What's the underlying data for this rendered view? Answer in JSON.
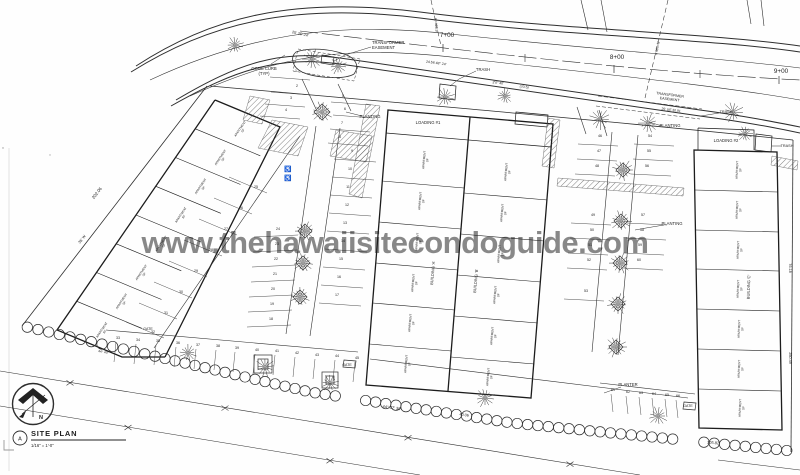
{
  "watermark": {
    "text": "www.thehawaiisitecondoguide.com",
    "color": "#a9a9a9"
  },
  "title_block": {
    "detail_letter": "A",
    "title": "SITE PLAN",
    "scale": "1/16\" = 1'-0\"",
    "north_letter": "N"
  },
  "stations": [
    {
      "label": "7+00",
      "x": 447,
      "y": 37,
      "tx": 443,
      "ty": 44
    },
    {
      "label": "8+00",
      "x": 617,
      "y": 59,
      "tx": 614,
      "ty": 65
    },
    {
      "label": "9+00",
      "x": 781,
      "y": 73,
      "tx": 779,
      "ty": 76
    }
  ],
  "unit_label": {
    "l1": "APARTMENT",
    "l2": "SF"
  },
  "buildings": {
    "names": [
      "BUILDING 'A'",
      "BUILDING 'B'",
      "BUILDING 'C'"
    ],
    "groups": [
      {
        "rot": -56,
        "pts": [
          [
            240.9,
            129.3
          ],
          [
            221.2,
            158
          ],
          [
            201.4,
            186.8
          ],
          [
            181.6,
            215.5
          ],
          [
            161.9,
            244.3
          ],
          [
            142.1,
            273
          ],
          [
            122.3,
            301.8
          ],
          [
            102.6,
            330.5
          ]
        ]
      },
      {
        "rot": -85,
        "pts": [
          [
            425,
            160
          ],
          [
            421,
            201
          ],
          [
            418,
            242
          ],
          [
            414,
            283
          ],
          [
            411,
            323
          ],
          [
            407,
            364
          ]
        ]
      },
      {
        "rot": -85,
        "pts": [
          [
            507,
            172
          ],
          [
            503,
            213
          ],
          [
            500,
            254
          ],
          [
            496,
            295
          ],
          [
            493,
            336
          ],
          [
            489,
            377
          ]
        ]
      },
      {
        "rot": -88,
        "pts": [
          [
            738,
            170
          ],
          [
            738,
            210
          ],
          [
            739,
            250
          ],
          [
            739,
            289
          ],
          [
            740,
            329
          ],
          [
            740,
            369
          ],
          [
            741,
            408
          ]
        ]
      }
    ]
  },
  "annotations": [
    {
      "lines": [
        "TRANSFORMER",
        "EASEMENT"
      ],
      "x": 372,
      "y": 44,
      "s": 4.2,
      "a": "start"
    },
    {
      "lines": [
        "CONC CURB",
        "(TYP)"
      ],
      "x": 264,
      "y": 70,
      "s": 4.2
    },
    {
      "t": "TRASH",
      "x": 483,
      "y": 71,
      "s": 4.2
    },
    {
      "t": "LOADING #1",
      "x": 428,
      "y": 124,
      "s": 4.2
    },
    {
      "t": "PLANTING",
      "x": 370,
      "y": 118,
      "s": 4.2
    },
    {
      "lines": [
        "TRANSFORMER",
        "EASEMENT"
      ],
      "x": 670,
      "y": 96,
      "s": 3.6,
      "r": 7
    },
    {
      "t": "25' UE  30.91",
      "x": 671,
      "y": 111,
      "s": 3.4,
      "r": 7
    },
    {
      "t": "PLANTING",
      "x": 670,
      "y": 127,
      "s": 4.2
    },
    {
      "t": "TRASH",
      "x": 726,
      "y": 113,
      "s": 3.8
    },
    {
      "t": "LOADING #2",
      "x": 726,
      "y": 142,
      "s": 4.2
    },
    {
      "t": "TRASH",
      "x": 787,
      "y": 147,
      "s": 3.8
    },
    {
      "t": "PLANTING",
      "x": 672,
      "y": 225,
      "s": 4.2
    },
    {
      "t": "PLANTER",
      "x": 628,
      "y": 386,
      "s": 4.2
    },
    {
      "t": "GATE",
      "x": 148,
      "y": 330,
      "s": 3.6
    },
    {
      "t": "GATE",
      "x": 347,
      "y": 366,
      "s": 3.6
    },
    {
      "t": "GATE",
      "x": 688,
      "y": 407,
      "s": 3.6
    },
    {
      "t": "202.06",
      "x": 98,
      "y": 194,
      "r": -52,
      "s": 4.4
    },
    {
      "t": "35' W",
      "x": 83,
      "y": 240,
      "r": -52,
      "s": 3.8
    },
    {
      "t": "25'   25'   24'",
      "x": 300,
      "y": 35,
      "r": 13,
      "s": 3.8
    },
    {
      "t": "24.56   48° 24'",
      "x": 436,
      "y": 64,
      "r": 8,
      "s": 3.5
    },
    {
      "t": "2'0\" 40'",
      "x": 498,
      "y": 84,
      "r": 7,
      "s": 3.5
    },
    {
      "t": "(70.5)",
      "x": 524,
      "y": 88,
      "r": 7,
      "s": 3.5
    },
    {
      "t": "R=428.9",
      "x": 435,
      "y": 25,
      "r": 85,
      "s": 3.5
    },
    {
      "t": "R=505.0",
      "x": 656,
      "y": 48,
      "r": 100,
      "s": 3.5
    },
    {
      "t": "44° 27' 30\"",
      "x": 392,
      "y": 409,
      "r": 8,
      "s": 4
    },
    {
      "t": "40.06",
      "x": 464,
      "y": 416,
      "r": 8,
      "s": 3.8
    },
    {
      "t": "105.82",
      "x": 713,
      "y": 444,
      "r": 4,
      "s": 4
    },
    {
      "t": "250.49",
      "x": 789,
      "y": 358,
      "r": 90,
      "s": 3.8
    },
    {
      "t": "76.18",
      "x": 789,
      "y": 268,
      "r": 90,
      "s": 3.8
    },
    {
      "t": "44° 40'",
      "x": 103,
      "y": 353,
      "r": 12,
      "s": 3.3
    },
    {
      "t": "♿",
      "x": 288,
      "y": 171,
      "s": 6
    },
    {
      "t": "♿",
      "x": 288,
      "y": 180,
      "s": 6
    },
    {
      "t": "BUILDING 'A'",
      "x": 434,
      "y": 273,
      "r": -85,
      "s": 4
    },
    {
      "t": "BUILDING 'B'",
      "x": 477,
      "y": 281,
      "r": -85,
      "s": 4
    },
    {
      "t": "BUILDING 'C'",
      "x": 750,
      "y": 287,
      "r": -88,
      "s": 4
    }
  ],
  "stalls": {
    "groups": [
      {
        "ox": -26,
        "oy": 5,
        "dx": 40,
        "dy": 3,
        "items": [
          {
            "n": "1",
            "x": 296,
            "y": 72
          },
          {
            "n": "2",
            "x": 297,
            "y": 87
          },
          {
            "n": "3",
            "x": 291,
            "y": 99
          },
          {
            "n": "4",
            "x": 286,
            "y": 111
          }
        ]
      },
      {
        "ox": -12,
        "oy": 5,
        "dx": 40,
        "dy": 3,
        "items": [
          {
            "n": "5",
            "x": 343,
            "y": 97
          },
          {
            "n": "6",
            "x": 345,
            "y": 110
          },
          {
            "n": "7",
            "x": 342,
            "y": 124
          },
          {
            "n": "8",
            "x": 340,
            "y": 138
          }
        ]
      },
      {
        "ox": -18,
        "oy": 7,
        "dx": 42,
        "dy": 3,
        "items": [
          {
            "n": "9",
            "x": 352,
            "y": 152
          },
          {
            "n": "10",
            "x": 350,
            "y": 170
          },
          {
            "n": "11",
            "x": 348,
            "y": 188
          },
          {
            "n": "12",
            "x": 347,
            "y": 206
          },
          {
            "n": "13",
            "x": 345,
            "y": 224
          },
          {
            "n": "14",
            "x": 343,
            "y": 242
          },
          {
            "n": "15",
            "x": 341,
            "y": 260
          },
          {
            "n": "16",
            "x": 339,
            "y": 278
          },
          {
            "n": "17",
            "x": 337,
            "y": 296
          }
        ]
      },
      {
        "ox": -24,
        "oy": 7,
        "dx": 44,
        "dy": -2,
        "items": [
          {
            "n": "24",
            "x": 278,
            "y": 230
          },
          {
            "n": "23",
            "x": 277,
            "y": 245
          },
          {
            "n": "22",
            "x": 276,
            "y": 260
          },
          {
            "n": "21",
            "x": 275,
            "y": 275
          },
          {
            "n": "20",
            "x": 273,
            "y": 290
          },
          {
            "n": "19",
            "x": 272,
            "y": 305
          },
          {
            "n": "18",
            "x": 271,
            "y": 320
          }
        ]
      },
      {
        "ox": -27,
        "oy": -11,
        "dx": 38,
        "dy": 16,
        "items": [
          {
            "n": "25",
            "x": 256,
            "y": 188
          },
          {
            "n": "26",
            "x": 241,
            "y": 209
          },
          {
            "n": "27",
            "x": 226,
            "y": 230
          },
          {
            "n": "28",
            "x": 211,
            "y": 251
          },
          {
            "n": "29",
            "x": 196,
            "y": 272
          },
          {
            "n": "30",
            "x": 181,
            "y": 293
          },
          {
            "n": "31",
            "x": 166,
            "y": 314
          },
          {
            "n": "32",
            "x": 153,
            "y": 333
          }
        ]
      },
      {
        "ox": -2,
        "oy": 3,
        "dx": -2,
        "dy": 20,
        "items": [
          {
            "n": "33",
            "x": 118,
            "y": 339
          },
          {
            "n": "34",
            "x": 138,
            "y": 341
          },
          {
            "n": "35",
            "x": 158,
            "y": 342
          },
          {
            "n": "36",
            "x": 178,
            "y": 344
          },
          {
            "n": "37",
            "x": 198,
            "y": 346
          },
          {
            "n": "38",
            "x": 218,
            "y": 347
          },
          {
            "n": "39",
            "x": 237,
            "y": 349
          },
          {
            "n": "40",
            "x": 257,
            "y": 351
          },
          {
            "n": "41",
            "x": 277,
            "y": 352
          },
          {
            "n": "42",
            "x": 297,
            "y": 354
          },
          {
            "n": "43",
            "x": 317,
            "y": 356
          },
          {
            "n": "44",
            "x": 337,
            "y": 357
          },
          {
            "n": "45",
            "x": 357,
            "y": 359
          }
        ]
      },
      {
        "ox": -22,
        "oy": 7,
        "dx": 40,
        "dy": 2,
        "items": [
          {
            "n": "46",
            "x": 600,
            "y": 137
          },
          {
            "n": "47",
            "x": 599,
            "y": 152
          },
          {
            "n": "48",
            "x": 597,
            "y": 167
          },
          {
            "n": "49",
            "x": 593,
            "y": 216
          },
          {
            "n": "50",
            "x": 592,
            "y": 231
          },
          {
            "n": "51",
            "x": 590,
            "y": 246
          },
          {
            "n": "52",
            "x": 589,
            "y": 261
          },
          {
            "n": "53",
            "x": 586,
            "y": 292
          }
        ]
      },
      {
        "ox": -16,
        "oy": 7,
        "dx": 40,
        "dy": 2,
        "items": [
          {
            "n": "54",
            "x": 650,
            "y": 137
          },
          {
            "n": "55",
            "x": 649,
            "y": 152
          },
          {
            "n": "56",
            "x": 647,
            "y": 167
          },
          {
            "n": "57",
            "x": 643,
            "y": 216
          },
          {
            "n": "58",
            "x": 642,
            "y": 231
          },
          {
            "n": "59",
            "x": 640,
            "y": 246
          },
          {
            "n": "60",
            "x": 639,
            "y": 261
          }
        ]
      },
      {
        "ox": -2,
        "oy": 3,
        "dx": 2,
        "dy": 18,
        "items": [
          {
            "n": "61",
            "x": 613,
            "y": 391
          },
          {
            "n": "62",
            "x": 628,
            "y": 393
          },
          {
            "n": "63",
            "x": 641,
            "y": 394
          },
          {
            "n": "64",
            "x": 654,
            "y": 395
          },
          {
            "n": "65",
            "x": 667,
            "y": 396
          },
          {
            "n": "66",
            "x": 678,
            "y": 397
          }
        ]
      }
    ]
  },
  "trees": [
    {
      "x": 235,
      "y": 45,
      "r": 9
    },
    {
      "x": 312,
      "y": 59,
      "r": 10
    },
    {
      "x": 338,
      "y": 66,
      "r": 9
    },
    {
      "x": 322,
      "y": 112,
      "r": 11
    },
    {
      "x": 445,
      "y": 97,
      "r": 10
    },
    {
      "x": 505,
      "y": 96,
      "r": 8
    },
    {
      "x": 600,
      "y": 119,
      "r": 11
    },
    {
      "x": 648,
      "y": 123,
      "r": 10
    },
    {
      "x": 733,
      "y": 112,
      "r": 11
    },
    {
      "x": 745,
      "y": 134,
      "r": 8
    },
    {
      "x": 305,
      "y": 231,
      "r": 10
    },
    {
      "x": 303,
      "y": 263,
      "r": 10
    },
    {
      "x": 300,
      "y": 297,
      "r": 10
    },
    {
      "x": 623,
      "y": 170,
      "r": 11
    },
    {
      "x": 621,
      "y": 221,
      "r": 11
    },
    {
      "x": 620,
      "y": 263,
      "r": 11
    },
    {
      "x": 618,
      "y": 304,
      "r": 11
    },
    {
      "x": 616,
      "y": 347,
      "r": 11
    },
    {
      "x": 188,
      "y": 353,
      "r": 9
    },
    {
      "x": 265,
      "y": 367,
      "r": 10
    },
    {
      "x": 330,
      "y": 383,
      "r": 9
    },
    {
      "x": 485,
      "y": 398,
      "r": 10
    },
    {
      "x": 658,
      "y": 416,
      "r": 10
    }
  ],
  "diamonds": [
    {
      "x": 322,
      "y": 112,
      "s": 8
    },
    {
      "x": 305,
      "y": 231,
      "s": 7
    },
    {
      "x": 303,
      "y": 263,
      "s": 7
    },
    {
      "x": 300,
      "y": 297,
      "s": 7
    },
    {
      "x": 623,
      "y": 170,
      "s": 7
    },
    {
      "x": 621,
      "y": 221,
      "s": 7
    },
    {
      "x": 620,
      "y": 263,
      "s": 7
    },
    {
      "x": 618,
      "y": 304,
      "s": 7
    },
    {
      "x": 616,
      "y": 347,
      "s": 7
    }
  ],
  "rock_wall": {
    "r": 5.2,
    "pts": [
      [
        22,
        326
      ],
      [
        150,
        355
      ],
      [
        310,
        392
      ],
      [
        512,
        423
      ],
      [
        792,
        451
      ]
    ],
    "gaps": [
      [
        336,
        356
      ],
      [
        678,
        700
      ]
    ]
  },
  "fences": [
    {
      "x1": 0,
      "y1": 371,
      "x2": 640,
      "y2": 475,
      "marks": [
        70,
        225,
        408,
        570
      ]
    },
    {
      "x1": 0,
      "y1": 406,
      "x2": 420,
      "y2": 475,
      "marks": [
        128,
        330
      ]
    }
  ]
}
